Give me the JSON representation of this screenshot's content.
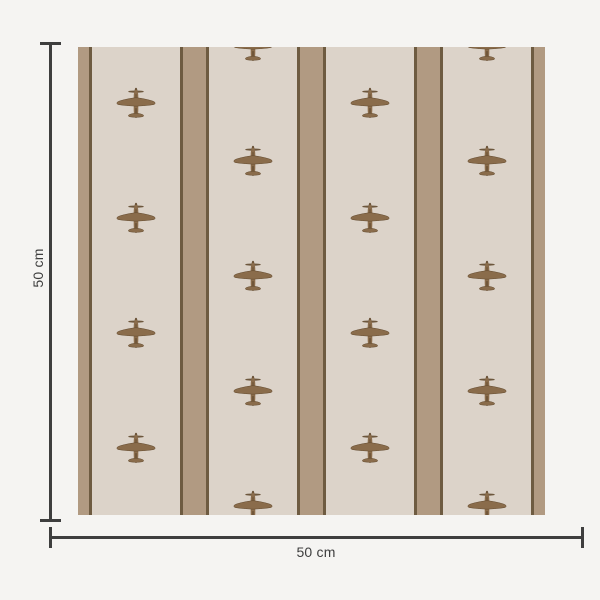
{
  "scene": {
    "background_color": "#f5f4f2",
    "dimension_color": "#3e3e3e"
  },
  "swatch": {
    "x": 78,
    "y": 47,
    "width": 467,
    "height": 468,
    "colors": {
      "ground": "#dcd3c9",
      "stripe": "#b19a82",
      "stripe_edge": "#6e5b41",
      "plane_body": "#8a6c4b",
      "plane_dark": "#61492e"
    },
    "stripe_layout": {
      "edge_stripe_width": 11,
      "edge_line_width": 3,
      "inner_stripe_width": 23,
      "ground_width": 88,
      "ground_count": 4
    },
    "plane_size": {
      "width": 40,
      "height": 34
    },
    "plane_columns": [
      {
        "x": 58,
        "ys": [
          57,
          172,
          287,
          402
        ]
      },
      {
        "x": 175,
        "ys": [
          0,
          115,
          230,
          345,
          460
        ]
      },
      {
        "x": 292,
        "ys": [
          57,
          172,
          287,
          402
        ]
      },
      {
        "x": 409,
        "ys": [
          0,
          115,
          230,
          345,
          460
        ]
      }
    ]
  },
  "dimensions": {
    "vertical": {
      "label": "50 cm",
      "x": 50,
      "y1": 43,
      "y2": 520,
      "cap_length": 21,
      "thickness": 3
    },
    "horizontal": {
      "label": "50 cm",
      "y": 537,
      "x1": 50,
      "x2": 582,
      "cap_length": 21,
      "thickness": 3
    }
  }
}
